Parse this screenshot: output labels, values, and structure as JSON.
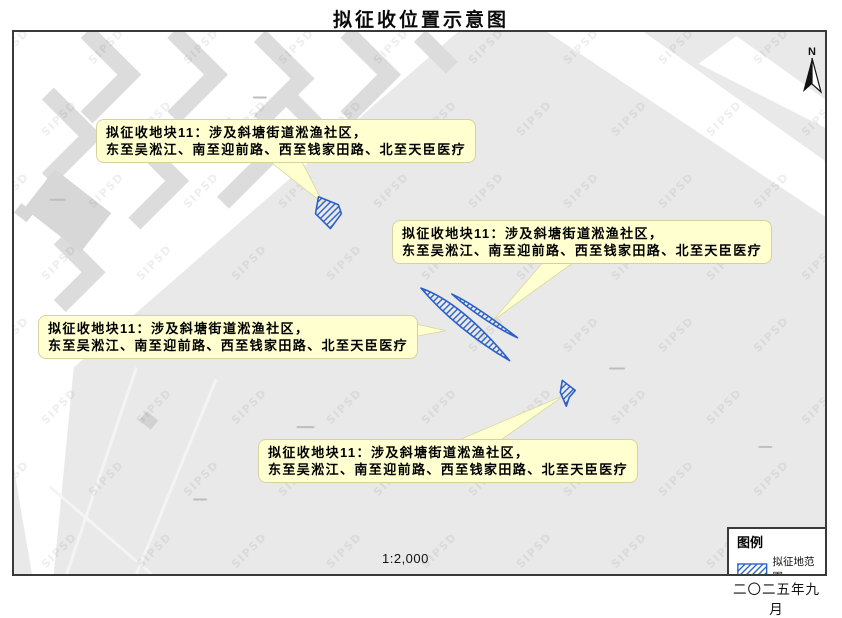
{
  "page": {
    "title": "拟征收位置示意图",
    "scale_label": "1:2,000",
    "date": "二〇二五年九月"
  },
  "map": {
    "watermark": "SIPSD",
    "north_label": "N"
  },
  "legend": {
    "title": "图例",
    "items": [
      {
        "label": "拟征地范围",
        "swatch": "blue-diagonal-hatch"
      }
    ]
  },
  "callouts": [
    {
      "id": "plot-11-top-left",
      "line1": "拟征收地块11：涉及斜塘街道淞渔社区，",
      "line2": "东至吴淞江、南至迎前路、西至钱家田路、北至天臣医疗"
    },
    {
      "id": "plot-11-top-right",
      "line1": "拟征收地块11：涉及斜塘街道淞渔社区，",
      "line2": "东至吴淞江、南至迎前路、西至钱家田路、北至天臣医疗"
    },
    {
      "id": "plot-11-middle-left",
      "line1": "拟征收地块11：涉及斜塘街道淞渔社区，",
      "line2": "东至吴淞江、南至迎前路、西至钱家田路、北至天臣医疗"
    },
    {
      "id": "plot-11-bottom",
      "line1": "拟征收地块11：涉及斜塘街道淞渔社区，",
      "line2": "东至吴淞江、南至迎前路、西至钱家田路、北至天臣医疗"
    }
  ],
  "colors": {
    "map_background": "#e9e9e9",
    "road_white": "#ffffff",
    "building_gray": "#dcdcdc",
    "callout_fill": "#ffffd0",
    "callout_border": "#d6d2a0",
    "parcel_outline": "#2a60c8",
    "frame_border": "#3a3a3a"
  }
}
